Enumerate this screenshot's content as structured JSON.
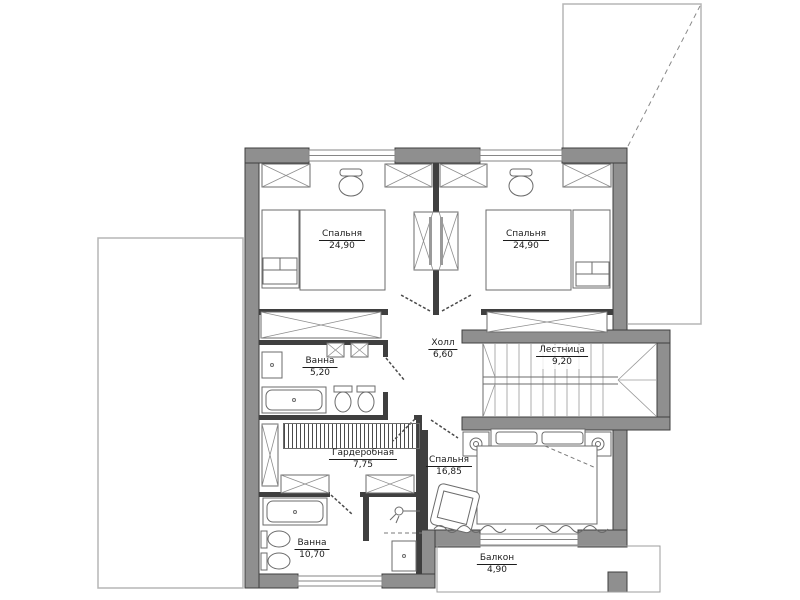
{
  "plan": {
    "rooms": [
      {
        "id": "bedroom-1",
        "name": "Спальня",
        "area": "24,90"
      },
      {
        "id": "bedroom-2",
        "name": "Спальня",
        "area": "24,90"
      },
      {
        "id": "hall",
        "name": "Холл",
        "area": "6,60"
      },
      {
        "id": "bath-1",
        "name": "Ванна",
        "area": "5,20"
      },
      {
        "id": "stairs",
        "name": "Лестница",
        "area": "9,20"
      },
      {
        "id": "wardrobe",
        "name": "Гардеробная",
        "area": "7,75"
      },
      {
        "id": "bedroom-3",
        "name": "Спальня",
        "area": "16,85"
      },
      {
        "id": "bath-2",
        "name": "Ванна",
        "area": "10,70"
      },
      {
        "id": "balcony",
        "name": "Балкон",
        "area": "4,90"
      }
    ],
    "furniture_icons": [
      "wardrobe-x-box",
      "double-bed",
      "desk-chair",
      "nightstand",
      "bathtub",
      "toilet",
      "sink",
      "shower",
      "armchair",
      "stair-treads",
      "clothes-rail-hatch",
      "curtain-wave"
    ],
    "colors": {
      "wall": "#8f8f8f",
      "wall_outline": "#3f3f3f",
      "line": "#6b6b6b",
      "roof_line": "#b5b5b5",
      "background": "#ffffff"
    }
  }
}
